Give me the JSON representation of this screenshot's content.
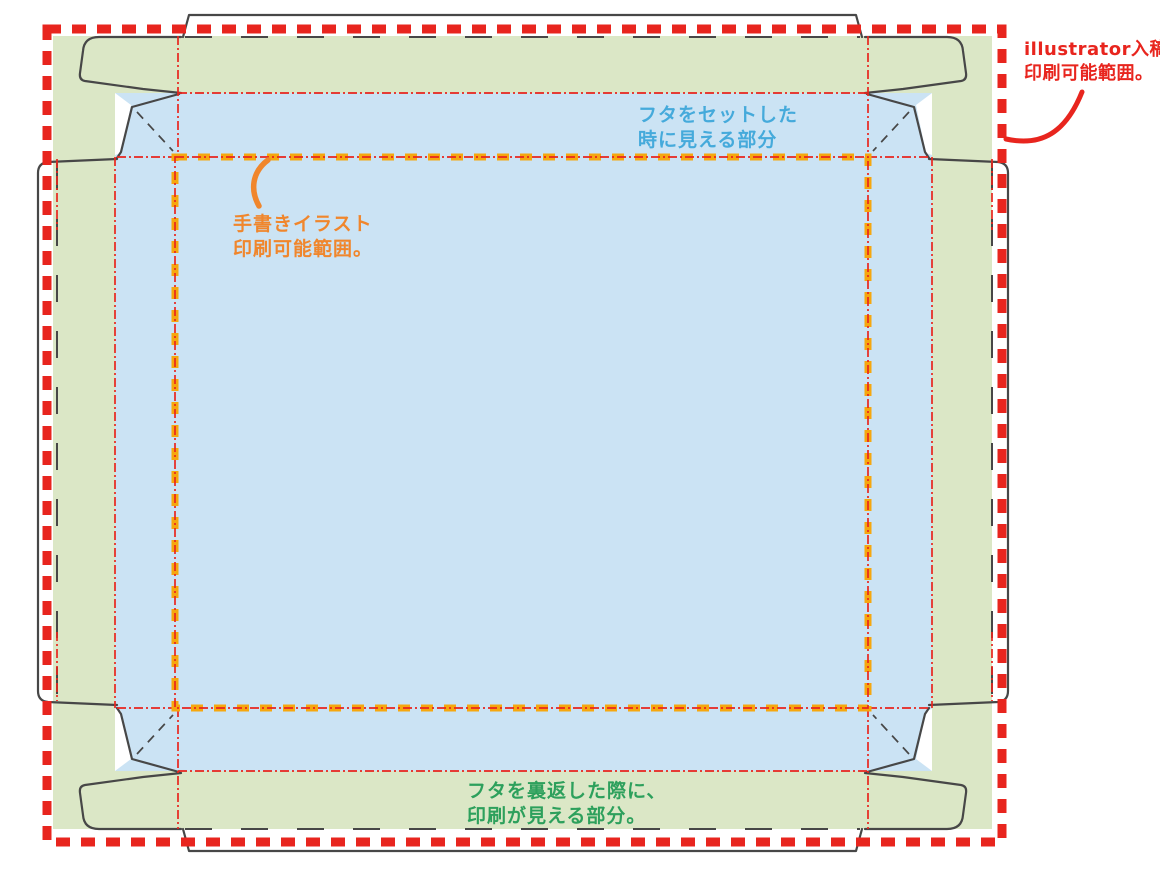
{
  "canvas": {
    "width": 1160,
    "height": 870
  },
  "colors": {
    "green_fill": "#dbe7c6",
    "blue_fill": "#cbe3f4",
    "red": "#e8251e",
    "orange_dash": "#f6a70e",
    "orange_text": "#f0862c",
    "blue_text": "#45aadb",
    "green_text": "#2da05c",
    "cut_line": "#474747"
  },
  "annotations": {
    "illustrator_range": {
      "line1": "illustrator入稿の",
      "line2": "印刷可能範囲。"
    },
    "lid_set_visible": {
      "line1": "フタをセットした",
      "line2": "時に見える部分"
    },
    "handdrawn_range": {
      "line1": "手書きイラスト",
      "line2": "印刷可能範囲。"
    },
    "lid_reversed_visible": {
      "line1": "フタを裏返した際に、",
      "line2": "印刷が見える部分。"
    }
  },
  "zones": {
    "green_zone_meaning": "フタを裏返した際に、印刷が見える部分。",
    "blue_zone_meaning": "フタをセットした時に見える部分",
    "red_border_meaning": "illustrator入稿の印刷可能範囲。",
    "orange_border_meaning": "手書きイラスト印刷可能範囲。"
  }
}
